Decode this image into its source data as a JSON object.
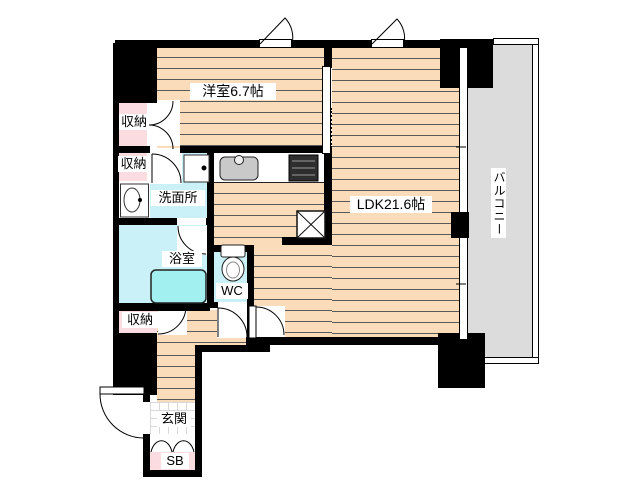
{
  "plan_title": "apartment-floor-plan",
  "rooms": {
    "western_room": {
      "label": "洋室6.7帖"
    },
    "ldk": {
      "label": "LDK21.6帖"
    },
    "balcony": {
      "label": "バルコニー"
    },
    "washroom": {
      "label": "洗面所"
    },
    "bathroom": {
      "label": "浴室"
    },
    "toilet": {
      "label": "WC"
    },
    "entrance": {
      "label": "玄関"
    },
    "shoe_box": {
      "label": "SB"
    },
    "storage_upper": {
      "label": "収納"
    },
    "storage_middle": {
      "label": "収納"
    },
    "storage_lower": {
      "label": "収納"
    }
  },
  "fixtures": [
    "kitchen-sink",
    "gas-stove",
    "refrigerator-space",
    "washing-machine-pan",
    "vanity-basin",
    "bathtub",
    "toilet-bowl"
  ],
  "colors": {
    "wall": "#000000",
    "flooring": "#fbdcba",
    "flooring_line": "#5a5a5a",
    "storage_pink": "#fadce1",
    "wet_area_blue": "#c9f1f7",
    "bathtub_cyan": "#a2f0f0",
    "balcony_gray": "#dcdcdc",
    "sink_gray": "#c9c9c9",
    "label_bg": "#ffffff",
    "label_text": "#000000"
  }
}
